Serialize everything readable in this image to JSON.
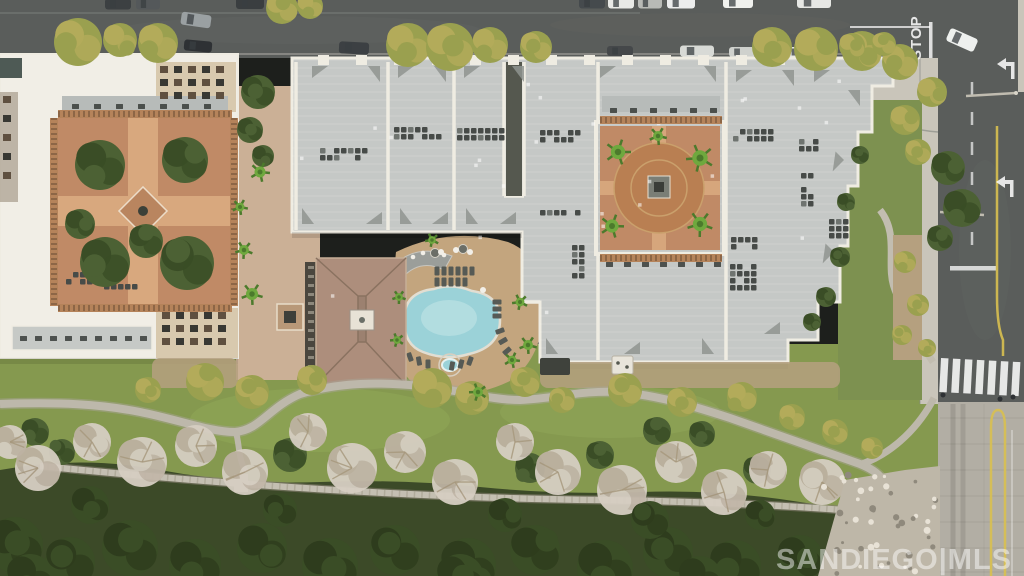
{
  "scene": {
    "type": "aerial-photograph",
    "description": "Overhead drone photo of a condominium complex: streets with parked cars at top and right, white-roofed building with planted courtyard at left, large gray-roofed residential blocks with circular terracotta courtyard, free-form swimming pool with tan deck and brown hip-roof clubhouse, landscaped park with winding paths, bare winter trees, dark forest and riprap rocks below",
    "watermark": "SANDIEGO|MLS",
    "road_markings": {
      "stop": "STOP"
    }
  },
  "palette": {
    "asphalt": "#5a5d5b",
    "asphalt_dark": "#4b4e4c",
    "concrete": "#c9c5ba",
    "concrete_road": "#b2aea4",
    "roof_white": "#f1eee6",
    "roof_gray": "#c5c8c6",
    "parapet": "#efece2",
    "facade_beige": "#d8c9ae",
    "courtyard_brick": "#c08a66",
    "brick_path": "#d8a87e",
    "pool_water": "#9bd2d8",
    "pool_glow": "#c4e6e8",
    "deck_tan": "#c3a57e",
    "plaza_tan": "#cbb096",
    "clubhouse_roof": "#ad8e7c",
    "grass": "#85994f",
    "slope_grass": "#7d9150",
    "forest": "#3c4a28",
    "tree_olive": "#9aa04f",
    "tree_olive_hi": "#b3ab5a",
    "tree_green": "#4c6134",
    "tree_green_dk": "#3a4d26",
    "tree_bare": "#d6cec2",
    "tree_bare_dk": "#bdb2a2",
    "palm": "#6fa83e",
    "palm_dk": "#4c7a2c",
    "path_gray": "#bdb8ab",
    "dirt_tan": "#b5a07f",
    "rock": "#beb7a8",
    "hvac": "#474b48",
    "railing": "#b5835a",
    "marking_white": "#ffffff",
    "marking_yellow": "#d8c050"
  },
  "objects": {
    "cars_top_road": [
      [
        118,
        4,
        26,
        11,
        "#3c4042",
        0
      ],
      [
        148,
        4,
        24,
        11,
        "#54585a",
        0
      ],
      [
        250,
        3,
        28,
        12,
        "#3a3e40",
        0
      ],
      [
        592,
        3,
        26,
        11,
        "#454a4d",
        0
      ],
      [
        621,
        3,
        26,
        11,
        "#e8e9e6",
        0
      ],
      [
        650,
        3,
        24,
        11,
        "#b8bab6",
        0
      ],
      [
        681,
        3,
        28,
        11,
        "#eceded",
        0
      ],
      [
        738,
        2,
        30,
        12,
        "#f0f1ee",
        0
      ],
      [
        814,
        2,
        34,
        12,
        "#e6e7e4",
        0
      ],
      [
        196,
        20,
        30,
        13,
        "#9aa0a2",
        8
      ],
      [
        198,
        46,
        28,
        11,
        "#2e3134",
        5
      ],
      [
        354,
        48,
        30,
        12,
        "#3c4043",
        3
      ],
      [
        620,
        51,
        26,
        10,
        "#45484a",
        0
      ],
      [
        697,
        51,
        34,
        11,
        "#d8dad6",
        0
      ],
      [
        742,
        52,
        26,
        10,
        "#cfd1cd",
        0
      ],
      [
        800,
        52,
        28,
        10,
        "#e2e3e0",
        0
      ]
    ],
    "intersection_car": [
      962,
      40,
      30,
      14,
      "#eef0ee",
      24
    ],
    "trees_olive": [
      [
        78,
        42,
        24
      ],
      [
        120,
        40,
        17
      ],
      [
        158,
        43,
        20
      ],
      [
        282,
        8,
        16
      ],
      [
        310,
        6,
        13
      ],
      [
        408,
        45,
        22
      ],
      [
        450,
        47,
        24
      ],
      [
        490,
        45,
        18
      ],
      [
        536,
        47,
        16
      ],
      [
        772,
        47,
        20
      ],
      [
        816,
        49,
        22
      ],
      [
        862,
        51,
        20
      ],
      [
        900,
        62,
        18
      ],
      [
        932,
        92,
        15
      ],
      [
        852,
        46,
        13
      ],
      [
        884,
        44,
        12
      ],
      [
        905,
        120,
        15
      ],
      [
        918,
        152,
        13
      ],
      [
        205,
        382,
        19
      ],
      [
        252,
        392,
        17
      ],
      [
        312,
        380,
        15
      ],
      [
        432,
        388,
        20
      ],
      [
        472,
        398,
        17
      ],
      [
        525,
        382,
        15
      ],
      [
        562,
        400,
        13
      ],
      [
        625,
        390,
        17
      ],
      [
        682,
        402,
        15
      ],
      [
        742,
        397,
        15
      ],
      [
        792,
        417,
        13
      ],
      [
        835,
        432,
        13
      ],
      [
        872,
        448,
        11
      ],
      [
        148,
        390,
        13
      ],
      [
        905,
        262,
        11
      ],
      [
        918,
        305,
        11
      ],
      [
        902,
        335,
        10
      ],
      [
        927,
        348,
        9
      ]
    ],
    "trees_green": [
      [
        100,
        165,
        25
      ],
      [
        185,
        160,
        23
      ],
      [
        105,
        262,
        25
      ],
      [
        187,
        263,
        27
      ],
      [
        146,
        241,
        17
      ],
      [
        80,
        224,
        15
      ],
      [
        258,
        92,
        17
      ],
      [
        250,
        130,
        13
      ],
      [
        263,
        156,
        11
      ],
      [
        948,
        168,
        17
      ],
      [
        962,
        208,
        19
      ],
      [
        940,
        238,
        13
      ],
      [
        290,
        455,
        17
      ],
      [
        530,
        468,
        15
      ],
      [
        600,
        455,
        14
      ],
      [
        657,
        431,
        14
      ],
      [
        702,
        434,
        13
      ],
      [
        757,
        470,
        14
      ],
      [
        860,
        155,
        9
      ],
      [
        846,
        202,
        9
      ],
      [
        840,
        257,
        10
      ],
      [
        826,
        297,
        10
      ],
      [
        812,
        322,
        9
      ],
      [
        35,
        432,
        14
      ],
      [
        62,
        452,
        13
      ]
    ],
    "trees_bare": [
      [
        10,
        442,
        17
      ],
      [
        38,
        468,
        23
      ],
      [
        92,
        442,
        19
      ],
      [
        142,
        462,
        25
      ],
      [
        196,
        446,
        21
      ],
      [
        245,
        472,
        23
      ],
      [
        308,
        432,
        19
      ],
      [
        352,
        468,
        25
      ],
      [
        405,
        452,
        21
      ],
      [
        455,
        482,
        23
      ],
      [
        515,
        442,
        19
      ],
      [
        558,
        472,
        23
      ],
      [
        622,
        490,
        25
      ],
      [
        676,
        462,
        21
      ],
      [
        724,
        492,
        23
      ],
      [
        768,
        470,
        19
      ],
      [
        822,
        482,
        23
      ],
      [
        864,
        502,
        19
      ],
      [
        908,
        524,
        17
      ]
    ],
    "trees_dark": [
      [
        15,
        545,
        28
      ],
      [
        70,
        562,
        25
      ],
      [
        130,
        548,
        28
      ],
      [
        195,
        565,
        26
      ],
      [
        262,
        548,
        25
      ],
      [
        330,
        566,
        28
      ],
      [
        395,
        550,
        25
      ],
      [
        468,
        566,
        28
      ],
      [
        535,
        550,
        25
      ],
      [
        605,
        568,
        28
      ],
      [
        668,
        552,
        25
      ],
      [
        735,
        566,
        26
      ],
      [
        800,
        558,
        23
      ],
      [
        855,
        572,
        21
      ],
      [
        90,
        505,
        19
      ],
      [
        280,
        510,
        17
      ],
      [
        505,
        515,
        17
      ],
      [
        650,
        520,
        19
      ],
      [
        760,
        515,
        15
      ],
      [
        30,
        578,
        24
      ],
      [
        460,
        578,
        24
      ],
      [
        700,
        578,
        22
      ]
    ],
    "palms": [
      [
        618,
        152,
        13
      ],
      [
        700,
        158,
        14
      ],
      [
        612,
        226,
        12
      ],
      [
        700,
        224,
        13
      ],
      [
        658,
        136,
        9
      ],
      [
        252,
        294,
        11
      ],
      [
        244,
        250,
        9
      ],
      [
        260,
        172,
        10
      ],
      [
        240,
        207,
        8
      ],
      [
        399,
        297,
        7
      ],
      [
        397,
        340,
        7
      ],
      [
        520,
        302,
        8
      ],
      [
        512,
        360,
        8
      ],
      [
        478,
        392,
        9
      ],
      [
        432,
        240,
        7
      ],
      [
        528,
        345,
        9
      ]
    ],
    "hvac_clusters": [
      [
        344,
        155,
        48,
        14
      ],
      [
        420,
        134,
        52,
        14
      ],
      [
        482,
        134,
        50,
        12
      ],
      [
        562,
        136,
        44,
        12
      ],
      [
        560,
        215,
        40,
        10
      ],
      [
        579,
        260,
        14,
        44
      ],
      [
        755,
        135,
        44,
        12
      ],
      [
        810,
        147,
        22,
        16
      ],
      [
        808,
        190,
        14,
        34
      ],
      [
        841,
        230,
        24,
        22
      ],
      [
        744,
        245,
        26,
        16
      ],
      [
        745,
        277,
        30,
        26
      ],
      [
        88,
        278,
        44,
        12
      ],
      [
        122,
        289,
        36,
        10
      ]
    ],
    "roof_triangles": [
      [
        312,
        66,
        0
      ],
      [
        380,
        66,
        90
      ],
      [
        398,
        66,
        0
      ],
      [
        446,
        66,
        90
      ],
      [
        464,
        66,
        0
      ],
      [
        524,
        66,
        90
      ],
      [
        600,
        66,
        0
      ],
      [
        716,
        66,
        90
      ],
      [
        736,
        70,
        0
      ],
      [
        794,
        70,
        90
      ],
      [
        814,
        70,
        0
      ],
      [
        860,
        90,
        90
      ],
      [
        302,
        224,
        270
      ],
      [
        382,
        224,
        180
      ],
      [
        400,
        224,
        270
      ],
      [
        448,
        224,
        180
      ],
      [
        466,
        224,
        270
      ],
      [
        516,
        224,
        180
      ],
      [
        546,
        354,
        270
      ],
      [
        640,
        354,
        180
      ],
      [
        702,
        354,
        270
      ],
      [
        780,
        334,
        180
      ],
      [
        844,
        160,
        135
      ],
      [
        834,
        252,
        135
      ]
    ],
    "parapet_notches": [
      318,
      356,
      394,
      432,
      470,
      508,
      546,
      584,
      622,
      660,
      698,
      736,
      774,
      812
    ],
    "parapet_lines": [
      [
        296,
        62,
        296,
        230
      ],
      [
        388,
        62,
        388,
        230
      ],
      [
        454,
        62,
        454,
        230
      ],
      [
        598,
        62,
        598,
        122
      ],
      [
        598,
        254,
        598,
        360
      ],
      [
        726,
        62,
        726,
        360
      ],
      [
        504,
        62,
        504,
        196
      ],
      [
        524,
        62,
        524,
        196
      ],
      [
        504,
        196,
        524,
        196
      ],
      [
        522,
        302,
        540,
        302
      ]
    ],
    "furniture_rows": [
      {
        "y": 104,
        "x0": 72,
        "x1": 206,
        "step": 22
      },
      {
        "y": 108,
        "x0": 610,
        "x1": 714,
        "step": 20
      },
      {
        "y": 262,
        "x0": 606,
        "x1": 716,
        "step": 18
      },
      {
        "y": 336,
        "x0": 20,
        "x1": 140,
        "step": 15
      }
    ],
    "loungers": [
      [
        437,
        271,
        0
      ],
      [
        444,
        271,
        0
      ],
      [
        451,
        271,
        0
      ],
      [
        458,
        271,
        0
      ],
      [
        465,
        271,
        0
      ],
      [
        472,
        271,
        0
      ],
      [
        437,
        282,
        0
      ],
      [
        444,
        282,
        0
      ],
      [
        451,
        282,
        0
      ],
      [
        458,
        282,
        0
      ],
      [
        465,
        282,
        0
      ],
      [
        497,
        302,
        90
      ],
      [
        497,
        309,
        90
      ],
      [
        497,
        316,
        90
      ],
      [
        500,
        331,
        70
      ],
      [
        503,
        341,
        60
      ],
      [
        507,
        351,
        50
      ],
      [
        410,
        357,
        -20
      ],
      [
        419,
        361,
        -10
      ],
      [
        428,
        364,
        0
      ],
      [
        452,
        366,
        10
      ],
      [
        461,
        364,
        15
      ],
      [
        470,
        361,
        20
      ]
    ],
    "pool_tables": [
      [
        441,
        252
      ],
      [
        456,
        250
      ],
      [
        470,
        252
      ],
      [
        483,
        290
      ]
    ],
    "pool_umbrellas": [
      [
        435,
        253
      ],
      [
        463,
        249
      ]
    ],
    "bar_stools": [
      [
        404,
        263
      ],
      [
        413,
        257
      ],
      [
        423,
        253
      ],
      [
        434,
        252
      ],
      [
        444,
        255
      ]
    ],
    "window_grids": [
      {
        "x": 160,
        "y": 66,
        "cols": 5,
        "rows": 3,
        "cw": 14,
        "ch": 13
      },
      {
        "x": 162,
        "y": 312,
        "cols": 5,
        "rows": 3,
        "cw": 14,
        "ch": 13
      },
      {
        "x": 3,
        "y": 96,
        "cols": 1,
        "rows": 5,
        "cw": 16,
        "ch": 19
      }
    ],
    "railings": [
      [
        58,
        114,
        232,
        114
      ],
      [
        58,
        308,
        232,
        308
      ],
      [
        54,
        118,
        54,
        306
      ],
      [
        234,
        118,
        234,
        306
      ],
      [
        600,
        258,
        722,
        258
      ],
      [
        600,
        120,
        722,
        120
      ]
    ],
    "crosswalk": {
      "x": 941,
      "y": 358,
      "count": 7,
      "w": 7.5,
      "h": 34,
      "gap": 12,
      "tilt": 3
    },
    "turn_arrows": [
      [
        1006,
        64
      ],
      [
        1005,
        182
      ]
    ],
    "pedestrians": [
      [
        943,
        395
      ],
      [
        1000,
        399
      ],
      [
        1013,
        397
      ]
    ],
    "concrete_seams_y": [
      418,
      444,
      470,
      496,
      522,
      548,
      572
    ]
  }
}
